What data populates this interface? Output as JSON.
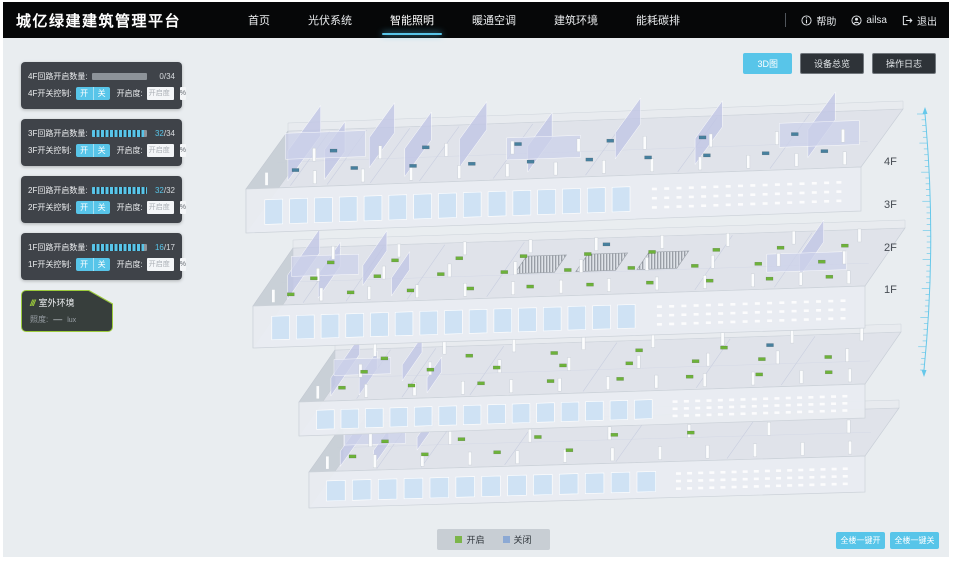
{
  "colors": {
    "accent": "#58c5e9",
    "marker_on": "#6db23a",
    "marker_off": "#47809e",
    "legend_on": "#7cb54a",
    "legend_off": "#8ca9d4",
    "ruler": "#66c8ea"
  },
  "header": {
    "brand": "城亿绿建建筑管理平台",
    "nav": [
      {
        "label": "首页",
        "active": false
      },
      {
        "label": "光伏系统",
        "active": false
      },
      {
        "label": "智能照明",
        "active": true
      },
      {
        "label": "暖通空调",
        "active": false
      },
      {
        "label": "建筑环境",
        "active": false
      },
      {
        "label": "能耗碳排",
        "active": false
      }
    ],
    "help_label": "帮助",
    "username": "ailsa",
    "logout_label": "退出"
  },
  "floor_panels": [
    {
      "floor": "4F",
      "circuit_label": "4F回路开启数量:",
      "open_count": 0,
      "total_count": 34,
      "value_current": "0",
      "value_rest": "/34",
      "progress": 0,
      "switch_label": "4F开关控制:",
      "on_label": "开",
      "off_label": "关",
      "openness_label": "开启度:",
      "openness_placeholder": "开启度",
      "percent_label": "%"
    },
    {
      "floor": "3F",
      "circuit_label": "3F回路开启数量:",
      "open_count": 32,
      "total_count": 34,
      "value_current": "32",
      "value_rest": "/34",
      "progress": 0.94,
      "switch_label": "3F开关控制:",
      "on_label": "开",
      "off_label": "关",
      "openness_label": "开启度:",
      "openness_placeholder": "开启度",
      "percent_label": "%"
    },
    {
      "floor": "2F",
      "circuit_label": "2F回路开启数量:",
      "open_count": 32,
      "total_count": 32,
      "value_current": "32",
      "value_rest": "/32",
      "progress": 1,
      "switch_label": "2F开关控制:",
      "on_label": "开",
      "off_label": "关",
      "openness_label": "开启度:",
      "openness_placeholder": "开启度",
      "percent_label": "%"
    },
    {
      "floor": "1F",
      "circuit_label": "1F回路开启数量:",
      "open_count": 16,
      "total_count": 17,
      "value_current": "16",
      "value_rest": "/17",
      "progress": 0.94,
      "switch_label": "1F开关控制:",
      "on_label": "开",
      "off_label": "关",
      "openness_label": "开启度:",
      "openness_placeholder": "开启度",
      "percent_label": "%"
    }
  ],
  "outdoor_panel": {
    "title": "室外环境",
    "illuminance_label": "照度:",
    "illuminance_value": "—",
    "illuminance_unit": "lux"
  },
  "view_toolbar": [
    {
      "label": "3D图",
      "active": true
    },
    {
      "label": "设备总览",
      "active": false
    },
    {
      "label": "操作日志",
      "active": false
    }
  ],
  "floor_axis_labels": [
    "4F",
    "3F",
    "2F",
    "1F"
  ],
  "legend": {
    "on_label": "开启",
    "off_label": "关闭"
  },
  "global_buttons": {
    "all_on": "全楼一键开",
    "all_off": "全楼一键关"
  }
}
